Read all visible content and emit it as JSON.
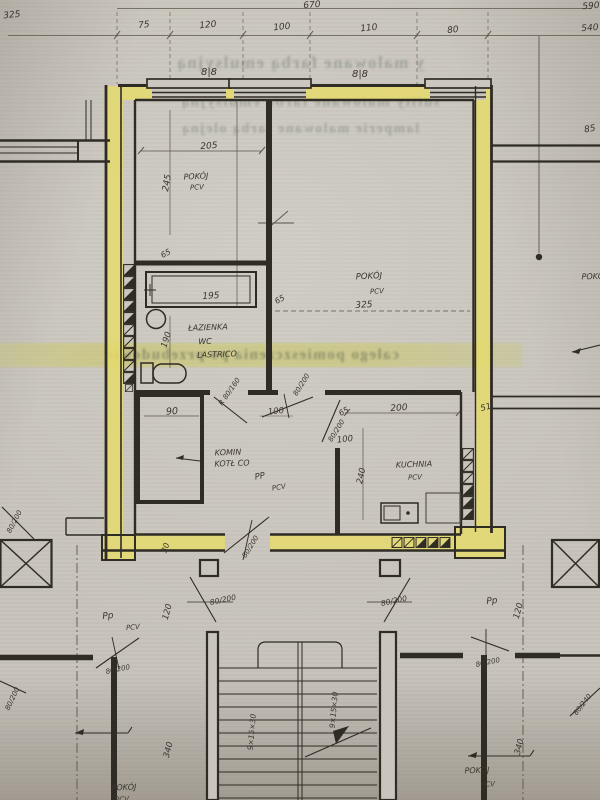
{
  "meta": {
    "kind": "scanned architectural floor plan photo",
    "language": "pl",
    "colors": {
      "paper": "#c7c3bb",
      "wall_highlight": "#e7dc6a",
      "ink": "#2f2b25",
      "pencil": "#5c564d",
      "bleed_text": "#68705c"
    }
  },
  "plan": {
    "rooms": [
      {
        "name": "POKÓJ",
        "floor": "PCV",
        "width_cm": "205",
        "depth_cm": "245"
      },
      {
        "name": "POKÓJ",
        "floor": "PCV",
        "size": "325"
      },
      {
        "name": "ŁAZIENKA WC",
        "floor": "LASTRICO"
      },
      {
        "name": "KOMIN KOTŁ CO",
        "width_cm": "90"
      },
      {
        "name": "KUCHNIA",
        "floor": "PCV",
        "width_cm": "200",
        "depth_cm": "240"
      },
      {
        "name": "POKÓJ (sąsiedni)",
        "floor": "PCV"
      }
    ],
    "stairs": {
      "steps": "9×15×30",
      "flights": 2
    },
    "labels": [
      {
        "n": "dim-670",
        "t": "670",
        "x": 312,
        "y": 6,
        "r": -4,
        "s": 9
      },
      {
        "n": "dim-325",
        "t": "325",
        "x": 12,
        "y": 16,
        "r": -6,
        "s": 9
      },
      {
        "n": "dim-75",
        "t": "75",
        "x": 144,
        "y": 26,
        "r": -6,
        "s": 9
      },
      {
        "n": "dim-120",
        "t": "120",
        "x": 208,
        "y": 26,
        "r": -6,
        "s": 9
      },
      {
        "n": "dim-100",
        "t": "100",
        "x": 282,
        "y": 28,
        "r": -6,
        "s": 9
      },
      {
        "n": "dim-110",
        "t": "110",
        "x": 369,
        "y": 29,
        "r": -6,
        "s": 9
      },
      {
        "n": "dim-80",
        "t": "80",
        "x": 453,
        "y": 31,
        "r": -6,
        "s": 9
      },
      {
        "n": "dim-590",
        "t": "590",
        "x": 591,
        "y": 7,
        "r": -4,
        "s": 9
      },
      {
        "n": "dim-540",
        "t": "540",
        "x": 590,
        "y": 29,
        "r": -4,
        "s": 9
      },
      {
        "n": "window-sill-mark-left",
        "t": "8|8",
        "x": 209,
        "y": 73,
        "r": 0,
        "s": 10
      },
      {
        "n": "window-sill-mark-right",
        "t": "8|8",
        "x": 360,
        "y": 75,
        "r": 0,
        "s": 10
      },
      {
        "n": "dim-85",
        "t": "85",
        "x": 590,
        "y": 130,
        "r": -10,
        "s": 9
      },
      {
        "n": "room1-name",
        "t": "POKÓJ",
        "x": 196,
        "y": 177,
        "r": -3,
        "s": 8
      },
      {
        "n": "room1-floor",
        "t": "PCV",
        "x": 197,
        "y": 188,
        "r": -3,
        "s": 7
      },
      {
        "n": "dim-205",
        "t": "205",
        "x": 209,
        "y": 147,
        "r": -4,
        "s": 9
      },
      {
        "n": "dim-245",
        "t": "245",
        "x": 168,
        "y": 183,
        "r": -80,
        "s": 9
      },
      {
        "n": "dim-65-bath-wall",
        "t": "65",
        "x": 166,
        "y": 254,
        "r": -28,
        "s": 8
      },
      {
        "n": "dim-195-tub",
        "t": "195",
        "x": 211,
        "y": 297,
        "r": -3,
        "s": 9
      },
      {
        "n": "bathroom-name",
        "t": "ŁAZIENKA",
        "x": 208,
        "y": 328,
        "r": -2,
        "s": 8
      },
      {
        "n": "bathroom-wc",
        "t": "WC",
        "x": 205,
        "y": 342,
        "r": -2,
        "s": 8
      },
      {
        "n": "bathroom-floor",
        "t": "LASTRICO",
        "x": 217,
        "y": 355,
        "r": -2,
        "s": 8
      },
      {
        "n": "dim-190",
        "t": "190",
        "x": 167,
        "y": 340,
        "r": -72,
        "s": 8.5
      },
      {
        "n": "room2-name",
        "t": "POKÓJ",
        "x": 369,
        "y": 277,
        "r": -3,
        "s": 8.5
      },
      {
        "n": "room2-floor",
        "t": "PCV",
        "x": 377,
        "y": 292,
        "r": -3,
        "s": 7
      },
      {
        "n": "room2-area",
        "t": "325",
        "x": 364,
        "y": 306,
        "r": -3,
        "s": 9
      },
      {
        "n": "dim-65-bathwall-right",
        "t": "65",
        "x": 280,
        "y": 300,
        "r": -28,
        "s": 8
      },
      {
        "n": "door-label-bath",
        "t": "R 80/160",
        "x": 230,
        "y": 392,
        "r": -55,
        "s": 7
      },
      {
        "n": "dim-90",
        "t": "90",
        "x": 172,
        "y": 412,
        "r": -3,
        "s": 9.5
      },
      {
        "n": "komin-name",
        "t": "KOMIN",
        "x": 228,
        "y": 453,
        "r": -2,
        "s": 8
      },
      {
        "n": "komin-name2",
        "t": "KOTŁ CO",
        "x": 232,
        "y": 464,
        "r": -2,
        "s": 8
      },
      {
        "n": "hall-pp",
        "t": "PP",
        "x": 260,
        "y": 477,
        "r": -10,
        "s": 8.5
      },
      {
        "n": "hall-floor",
        "t": "PCV",
        "x": 279,
        "y": 488,
        "r": -10,
        "s": 7
      },
      {
        "n": "dim-100-bathdoor",
        "t": "100",
        "x": 276,
        "y": 412,
        "r": -6,
        "s": 8.5
      },
      {
        "n": "door-label-room2",
        "t": "80/200",
        "x": 302,
        "y": 385,
        "r": -58,
        "s": 7
      },
      {
        "n": "dim-65-kitchendoor",
        "t": "65",
        "x": 344,
        "y": 412,
        "r": -28,
        "s": 8
      },
      {
        "n": "door-label-kitchen",
        "t": "80/200",
        "x": 337,
        "y": 431,
        "r": -58,
        "s": 7
      },
      {
        "n": "dim-100-kitchendoor",
        "t": "100",
        "x": 345,
        "y": 440,
        "r": -6,
        "s": 8.5
      },
      {
        "n": "dim-200-kitchen",
        "t": "200",
        "x": 399,
        "y": 409,
        "r": -4,
        "s": 9
      },
      {
        "n": "dim-51",
        "t": "51",
        "x": 486,
        "y": 408,
        "r": -15,
        "s": 8.5
      },
      {
        "n": "kitchen-name",
        "t": "KUCHNIA",
        "x": 414,
        "y": 465,
        "r": -2,
        "s": 8
      },
      {
        "n": "kitchen-floor",
        "t": "PCV",
        "x": 415,
        "y": 478,
        "r": -2,
        "s": 7
      },
      {
        "n": "dim-240-kitchen",
        "t": "240",
        "x": 362,
        "y": 476,
        "r": -78,
        "s": 8.5
      },
      {
        "n": "dim-30",
        "t": "30",
        "x": 166,
        "y": 548,
        "r": -70,
        "s": 8
      },
      {
        "n": "door-label-entry",
        "t": "80/200",
        "x": 251,
        "y": 547,
        "r": -58,
        "s": 7
      },
      {
        "n": "door-label-corridor-left",
        "t": "80/200",
        "x": 15,
        "y": 522,
        "r": -62,
        "s": 7
      },
      {
        "n": "dim-120-left",
        "t": "120",
        "x": 168,
        "y": 612,
        "r": -75,
        "s": 8.5
      },
      {
        "n": "dim-340-left",
        "t": "340",
        "x": 169,
        "y": 750,
        "r": -75,
        "s": 8.5
      },
      {
        "n": "dim-120-right",
        "t": "120",
        "x": 519,
        "y": 611,
        "r": -75,
        "s": 8.5
      },
      {
        "n": "dim-340-right",
        "t": "340",
        "x": 520,
        "y": 747,
        "r": -75,
        "s": 8.5
      },
      {
        "n": "door-label-stair-left",
        "t": "80/200",
        "x": 223,
        "y": 600,
        "r": -12,
        "s": 7.5
      },
      {
        "n": "door-label-stair-right",
        "t": "80/200",
        "x": 394,
        "y": 601,
        "r": -12,
        "s": 7.5
      },
      {
        "n": "stair-steps-left",
        "t": "9×15×30",
        "x": 252,
        "y": 732,
        "r": -85,
        "s": 7.5
      },
      {
        "n": "stair-steps-right",
        "t": "9×15×30",
        "x": 334,
        "y": 710,
        "r": -85,
        "s": 7.5
      },
      {
        "n": "left-flat-pp",
        "t": "Pp",
        "x": 108,
        "y": 617,
        "r": -5,
        "s": 9
      },
      {
        "n": "left-flat-floor",
        "t": "PCV",
        "x": 133,
        "y": 628,
        "r": -5,
        "s": 7
      },
      {
        "n": "door-label-left-flat",
        "t": "80/200",
        "x": 118,
        "y": 670,
        "r": -12,
        "s": 7
      },
      {
        "n": "door-label-left-wall",
        "t": "80/200",
        "x": 13,
        "y": 699,
        "r": -65,
        "s": 7
      },
      {
        "n": "left-flat-room",
        "t": "POKÓJ",
        "x": 124,
        "y": 788,
        "r": -2,
        "s": 8
      },
      {
        "n": "left-flat-room-floor",
        "t": "PCV",
        "x": 122,
        "y": 800,
        "r": -2,
        "s": 7
      },
      {
        "n": "right-flat-pp",
        "t": "Pp",
        "x": 492,
        "y": 602,
        "r": -5,
        "s": 9
      },
      {
        "n": "door-label-right-flat",
        "t": "80/200",
        "x": 488,
        "y": 663,
        "r": -12,
        "s": 7
      },
      {
        "n": "door-label-right-wall",
        "t": "80/240",
        "x": 583,
        "y": 705,
        "r": -52,
        "s": 7
      },
      {
        "n": "right-flat-room",
        "t": "POKÓJ",
        "x": 477,
        "y": 771,
        "r": -2,
        "s": 8
      },
      {
        "n": "right-flat-floor",
        "t": "PCV",
        "x": 488,
        "y": 785,
        "r": -2,
        "s": 7
      },
      {
        "n": "right-room-name",
        "t": "POKÓJ",
        "x": 594,
        "y": 277,
        "r": -2,
        "s": 8
      }
    ],
    "bleed_lines": [
      {
        "n": "bleed-line-1",
        "t": "y malowane farbą emulsyjną",
        "x": 300,
        "y": 63,
        "s": 17,
        "hl": false
      },
      {
        "n": "bleed-line-2",
        "t": "sufity malowane farbą emulsyjną",
        "x": 310,
        "y": 102,
        "s": 15,
        "hl": false
      },
      {
        "n": "bleed-line-3",
        "t": "lamperie malowane farbą olejną",
        "x": 300,
        "y": 130,
        "s": 14,
        "hl": false
      },
      {
        "n": "bleed-line-4",
        "t": "całego pomieszczenia po przebudowie",
        "x": 252,
        "y": 355,
        "s": 15,
        "hl": true,
        "w": 520
      }
    ]
  }
}
